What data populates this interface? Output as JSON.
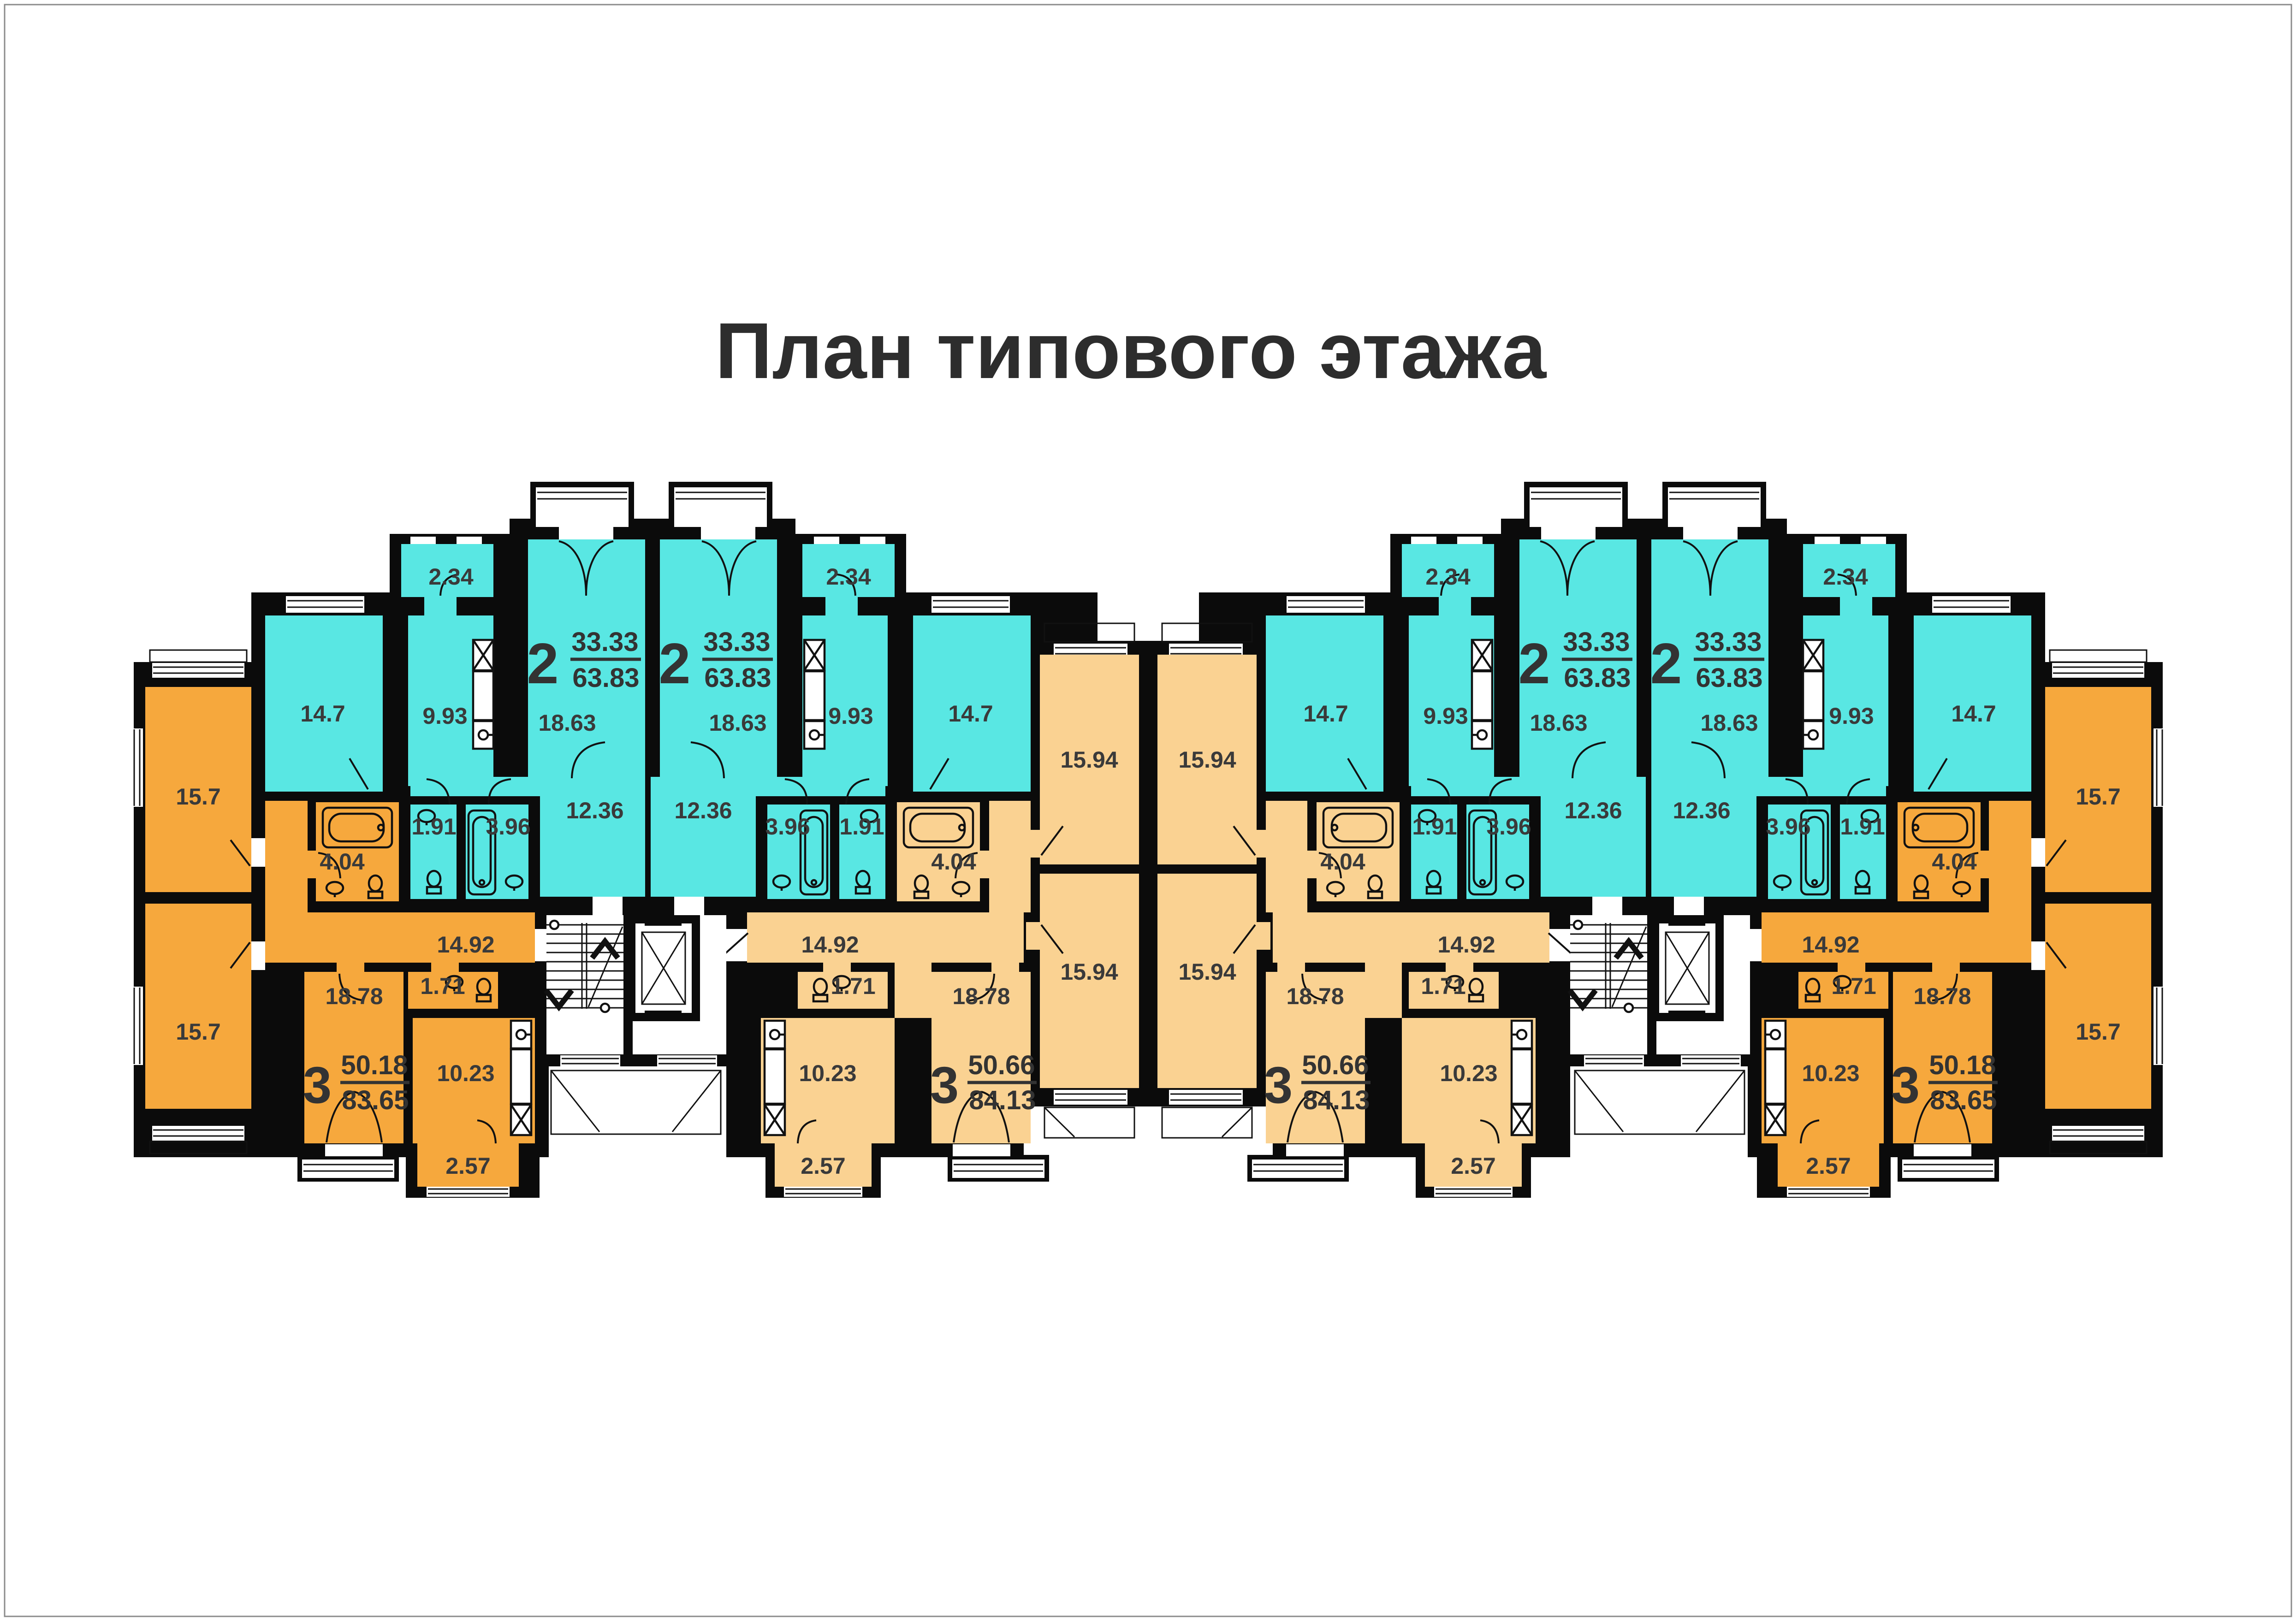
{
  "title": "План типового этажа",
  "apartments": {
    "two_room": {
      "number": "2",
      "living_area": "33.33",
      "total_area": "63.83"
    },
    "three_room_a": {
      "number": "3",
      "living_area": "50.18",
      "total_area": "83.65"
    },
    "three_room_b": {
      "number": "3",
      "living_area": "50.66",
      "total_area": "84.13"
    }
  },
  "rooms": {
    "living_157": "15.7",
    "living_1594": "15.94",
    "living_147": "14.7",
    "living_1863": "18.63",
    "living_1878": "18.78",
    "kitchen_993": "9.93",
    "kitchen_1023": "10.23",
    "hall_1236": "12.36",
    "hall_1492": "14.92",
    "bath_396": "3.96",
    "bath_404": "4.04",
    "wc_191": "1.91",
    "wc_171": "1.71",
    "balcony_234": "2.34",
    "balcony_257": "2.57"
  },
  "colors": {
    "two_room_fill": "#59E7E3",
    "three_room_a_fill": "#F6A83D",
    "three_room_b_fill": "#FAD292",
    "wall": "#0B0B0B",
    "label_text": "#3A3A3A"
  }
}
